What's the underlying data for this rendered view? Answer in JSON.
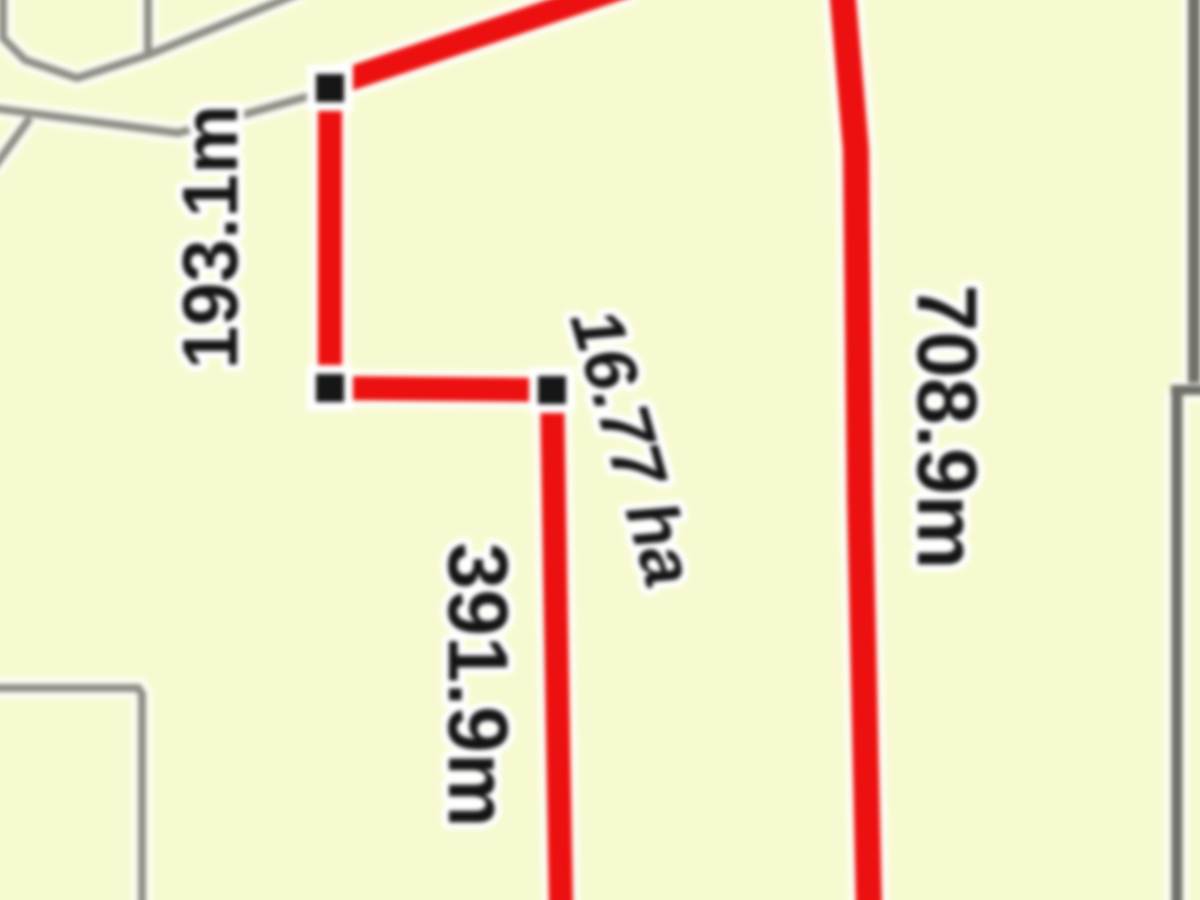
{
  "app": {
    "view_type": "cadastral-parcel-map"
  },
  "colors": {
    "background": "#f7fad3",
    "boundary_gray": "#8e8e86",
    "boundary_dark_gray": "#6f6f68",
    "casing_white": "#fcfdf2",
    "measurement_red": "#e51212",
    "marker_black": "#161616",
    "label_text": "#141414",
    "label_halo": "#ffffff"
  },
  "map": {
    "width": 1200,
    "height": 900,
    "boundary_lines": [
      {
        "name": "parcel-outline-top-left",
        "points": [
          [
            148,
            -8
          ],
          [
            148,
            55
          ],
          [
            77,
            78
          ],
          [
            25,
            60
          ],
          [
            3,
            38
          ],
          [
            3,
            -8
          ]
        ],
        "width": 8,
        "dark": false
      },
      {
        "name": "boundary-diagonal-top",
        "points": [
          [
            148,
            55
          ],
          [
            302,
            -8
          ]
        ],
        "width": 8,
        "dark": false
      },
      {
        "name": "boundary-to-vertex",
        "points": [
          [
            -8,
            108
          ],
          [
            178,
            133
          ],
          [
            324,
            92
          ]
        ],
        "width": 8,
        "dark": false
      },
      {
        "name": "boundary-left-stub",
        "points": [
          [
            -8,
            170
          ],
          [
            30,
            118
          ]
        ],
        "width": 8,
        "dark": false
      },
      {
        "name": "boundary-bottom-left-corner",
        "points": [
          [
            -8,
            688
          ],
          [
            138,
            688
          ],
          [
            142,
            694
          ],
          [
            142,
            908
          ]
        ],
        "width": 8,
        "dark": false
      },
      {
        "name": "boundary-right-upper",
        "points": [
          [
            1194,
            -8
          ],
          [
            1194,
            383
          ]
        ],
        "width": 12,
        "dark": true
      },
      {
        "name": "boundary-right-step",
        "points": [
          [
            1171,
            390
          ],
          [
            1204,
            390
          ]
        ],
        "width": 10,
        "dark": true
      },
      {
        "name": "boundary-right-lower",
        "points": [
          [
            1177,
            390
          ],
          [
            1177,
            908
          ]
        ],
        "width": 11,
        "dark": true
      }
    ],
    "measurement_lines": [
      {
        "name": "measured-parcel-outline",
        "points": [
          [
            632,
            -16
          ],
          [
            334,
            84
          ],
          [
            330,
            96
          ],
          [
            330,
            388
          ],
          [
            552,
            390
          ],
          [
            561,
            908
          ]
        ],
        "width": 24
      },
      {
        "name": "measured-boundary-right",
        "points": [
          [
            842,
            -12
          ],
          [
            856,
            150
          ],
          [
            860,
            500
          ],
          [
            869,
            908
          ]
        ],
        "width": 26
      }
    ],
    "vertex_markers": [
      {
        "x": 330,
        "y": 88
      },
      {
        "x": 330,
        "y": 388
      },
      {
        "x": 552,
        "y": 390
      }
    ],
    "labels": [
      {
        "id": "segment-length-1",
        "kind": "length",
        "text": "193.1m",
        "x": 209,
        "y": 237,
        "rotate": -90,
        "size": 78,
        "italic": false
      },
      {
        "id": "segment-length-2",
        "kind": "length",
        "text": "391.9m",
        "x": 479,
        "y": 685,
        "rotate": 90,
        "size": 84,
        "italic": false
      },
      {
        "id": "segment-length-3",
        "kind": "length",
        "text": "708.9m",
        "x": 948,
        "y": 427,
        "rotate": 90,
        "size": 84,
        "italic": false
      },
      {
        "id": "parcel-area",
        "kind": "area",
        "text": "16.77 ha",
        "x": 634,
        "y": 447,
        "rotate": 74,
        "size": 72,
        "italic": true
      }
    ]
  }
}
